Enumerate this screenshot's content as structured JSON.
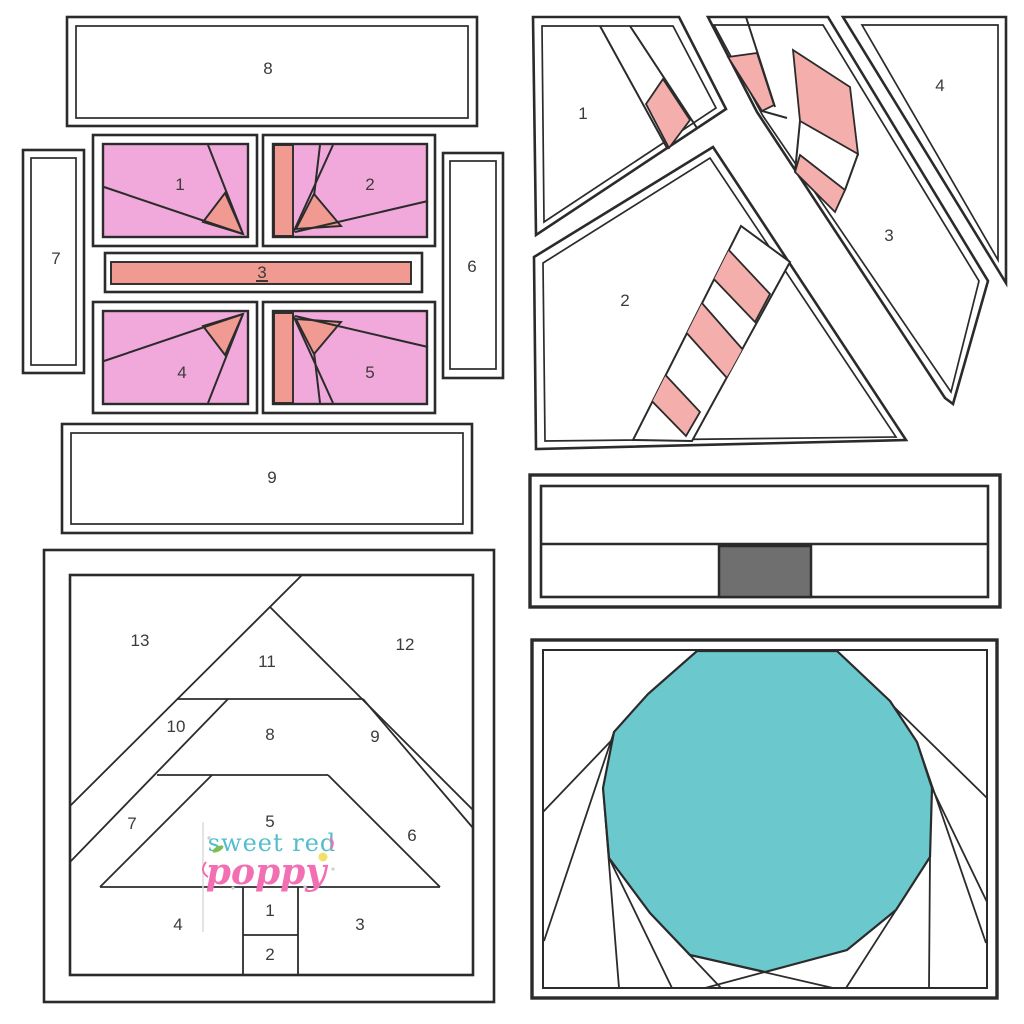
{
  "colors": {
    "bg": "#ffffff",
    "line": "#2b2b2b",
    "label": "#3b3b3b",
    "pink": "#f0a9da",
    "salmon": "#f09a92",
    "salmonLight": "#f4afad",
    "teal": "#6bc9ce",
    "grayBox": "#6f6f6f",
    "logoTeal": "#52becd",
    "logoPink": "#f26fb4",
    "logoGreen": "#7bbf4e",
    "logoYellow": "#f2e06a",
    "watermark": "#dbdbdb",
    "sparkle": "#cfcfcf"
  },
  "blocks": {
    "present": {
      "name": "gift-box-paper-piecing-block",
      "labels": [
        "1",
        "2",
        "3",
        "4",
        "5",
        "6",
        "7",
        "8",
        "9"
      ]
    },
    "candy_cane": {
      "name": "candy-cane-paper-piecing-block",
      "labels": [
        "1",
        "2",
        "3",
        "4"
      ]
    },
    "tree": {
      "name": "christmas-tree-paper-piecing-block",
      "labels": [
        "1",
        "2",
        "3",
        "4",
        "5",
        "6",
        "7",
        "8",
        "9",
        "10",
        "11",
        "12",
        "13"
      ]
    },
    "bar": {
      "name": "strip-block-with-gray-square"
    },
    "ornament": {
      "name": "ornament-circle-fold-block"
    }
  },
  "logo": {
    "line1": "sweet red",
    "line2": "poppy"
  }
}
